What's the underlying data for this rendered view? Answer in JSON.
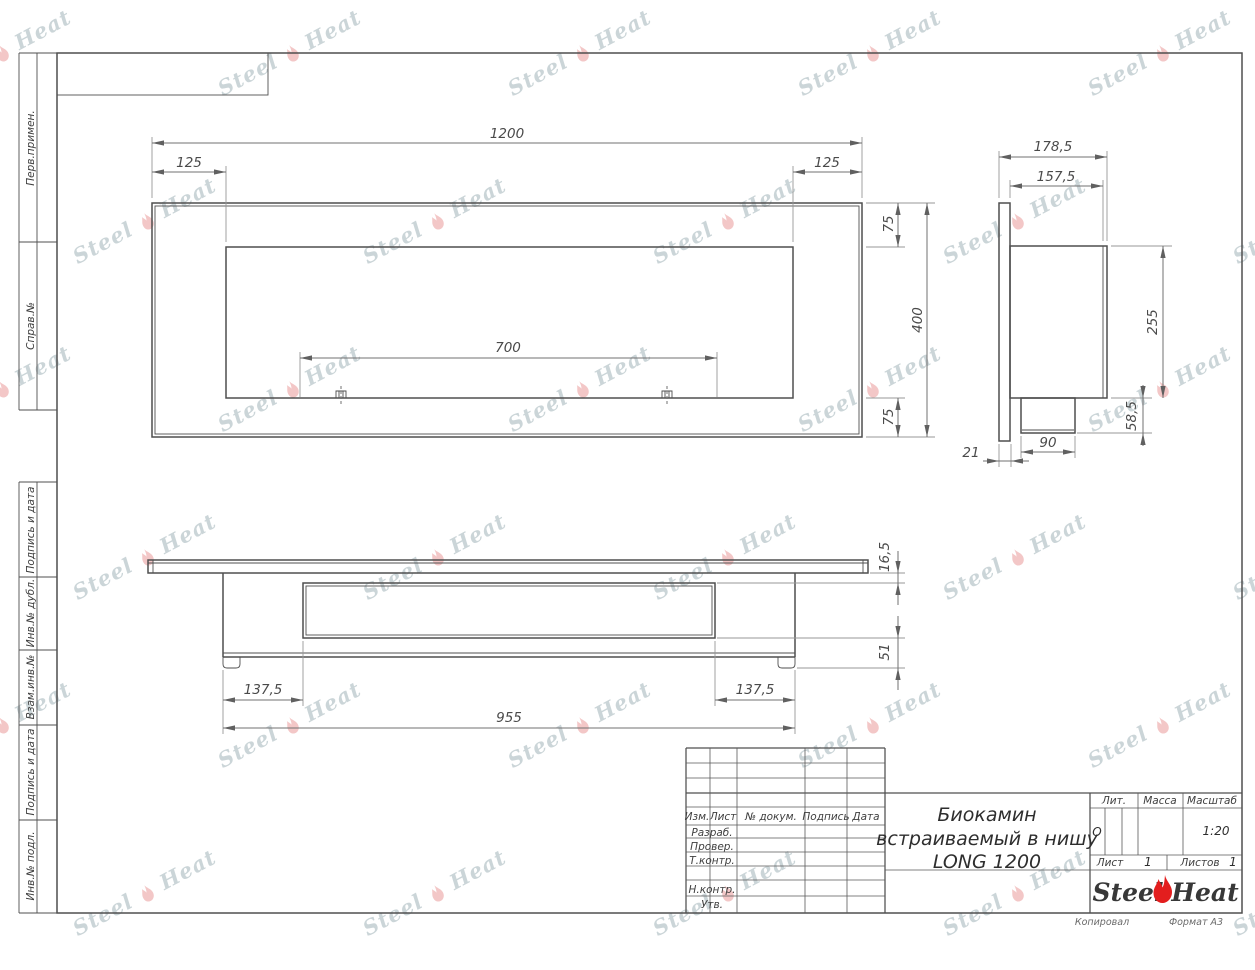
{
  "watermark": {
    "text_left": "Steel",
    "text_right": "Heat"
  },
  "colors": {
    "flame_red": "#e31e1e",
    "watermark_text": "rgba(130,156,163,0.42)",
    "watermark_flame": "rgba(228,130,130,0.45)"
  },
  "margin": {
    "labels": [
      "Перв.примен.",
      "Справ.№",
      "Подпись и дата",
      "Инв.№ дубл.",
      "Взам.инв.№",
      "Подпись и дата",
      "Инв.№ подл."
    ]
  },
  "footer": {
    "copied": "Копировал",
    "format": "Формат А3"
  },
  "title_block": {
    "cols": {
      "izm": "Изм.",
      "list": "Лист",
      "doc": "№ докум.",
      "sign": "Подпись",
      "date": "Дата"
    },
    "roles": [
      "Разраб.",
      "Провер.",
      "Т.контр.",
      "Н.контр.",
      "Утв."
    ],
    "title_line1": "Биокамин",
    "title_line2": "встраиваемый в нишу",
    "title_line3": "LONG 1200",
    "lit_label": "Лит.",
    "lit_value": "О",
    "mass_label": "Масса",
    "scale_label": "Масштаб",
    "scale_value": "1:20",
    "sheet_label": "Лист",
    "sheet_number": "1",
    "sheets_label": "Листов",
    "sheets_total": "1",
    "logo_left": "Steel",
    "logo_right": "Heat"
  },
  "dimensions": {
    "front": {
      "total_width": "1200",
      "left_inset": "125",
      "right_inset": "125",
      "burner_width": "700",
      "top_margin": "75",
      "height": "400",
      "bottom_margin": "75"
    },
    "side": {
      "depth_total": "178,5",
      "depth_body": "157,5",
      "body_height": "255",
      "foot_height": "58,5",
      "foot_width": "90",
      "flange_thickness": "21"
    },
    "plan": {
      "plate_thickness": "16,5",
      "body_drop": "51",
      "left_offset": "137,5",
      "right_offset": "137,5",
      "body_width": "955"
    }
  }
}
